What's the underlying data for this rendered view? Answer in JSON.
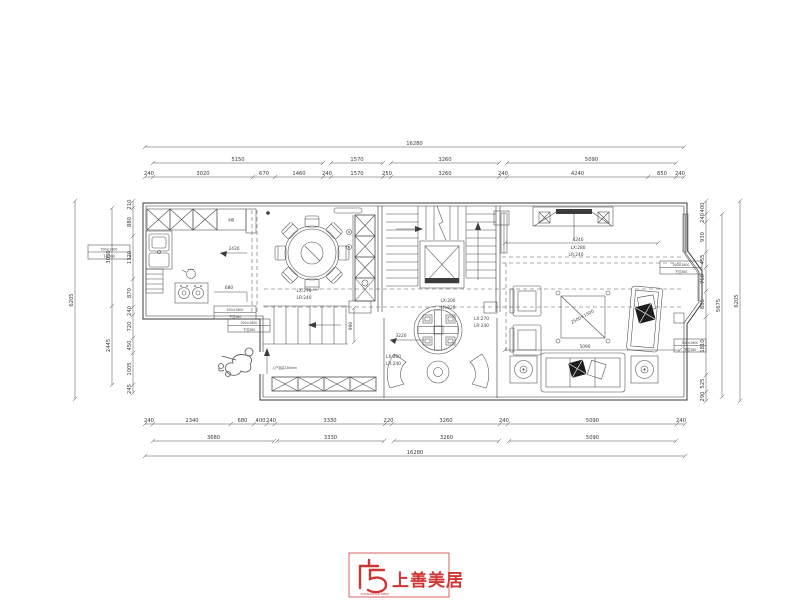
{
  "logo": {
    "name": "上善美居",
    "caption": "SHANGSHAN MEIJU",
    "color": "#cf3535"
  },
  "dims": {
    "top": {
      "total": "16280",
      "row2": [
        "5150",
        "1570",
        "3260",
        "5090"
      ],
      "row3": [
        "240",
        "3020",
        "670",
        "1460",
        "240",
        "1570",
        "250",
        "3260",
        "240",
        "4240",
        "850",
        "240"
      ]
    },
    "bottom": {
      "row1": [
        "240",
        "2340",
        "680",
        "400",
        "240",
        "3330",
        "220",
        "3260",
        "240",
        "5090",
        "240"
      ],
      "row2": [
        "3680",
        "3330",
        "3260",
        "5090"
      ],
      "total": "16280"
    },
    "left": {
      "outer": "6205",
      "mid": [
        "3050",
        "2445"
      ],
      "inner": [
        "210",
        "880",
        "1320",
        "870",
        "240",
        "720",
        "450",
        "1005",
        "245"
      ]
    },
    "right": {
      "outer": "6205",
      "mid": "5675",
      "inner": [
        "400",
        "240",
        "930",
        "455",
        "760",
        "805",
        "1810",
        "525",
        "290"
      ]
    }
  },
  "rooms": {
    "kitchen": {
      "dim1": "2430",
      "dim2": "680",
      "fridge": "冰箱"
    },
    "dining": {
      "lx": "LX:270",
      "lr": "LR:240"
    },
    "stair": {
      "lx": "LX:200",
      "lr": "LR:220",
      "step_dim": "990"
    },
    "tea": {
      "dim": "3220",
      "left_lx": "LX:400",
      "left_lr": "LR:240",
      "right_lx": "LX:270",
      "right_lr": "LR:240"
    },
    "living": {
      "wall_dim": "4240",
      "lx": "LX:280",
      "lr": "LR:240",
      "width_dim": "5090",
      "table": "2500×1500"
    },
    "entry": {
      "note": "入户抬高180mm"
    }
  },
  "annotation": {
    "line1": "500×2800",
    "line2": "下沉380"
  }
}
